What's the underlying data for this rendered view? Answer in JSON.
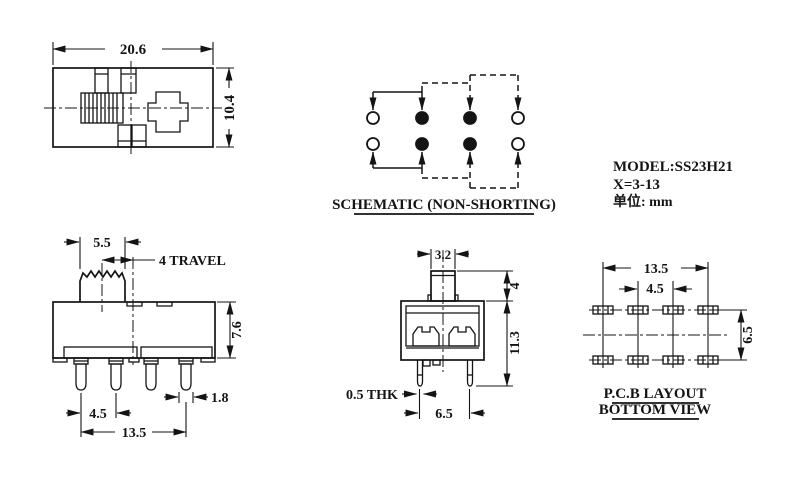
{
  "drawing_info": {
    "model": "MODEL:SS23H21",
    "travel_range": "X=3-13",
    "unit": "单位: mm",
    "line_color": "#141414",
    "background_color": "#ffffff"
  },
  "top_view": {
    "dim_width": "20.6",
    "dim_height": "10.4"
  },
  "schematic": {
    "title": "SCHEMATIC (NON-SHORTING)",
    "pin_rows": 2,
    "pins_per_row": 4,
    "pin_states": [
      [
        "open",
        "filled",
        "filled",
        "open"
      ],
      [
        "open",
        "filled",
        "filled",
        "open"
      ]
    ],
    "position1_linkage": "solid",
    "position2_3_linkage": "dashed"
  },
  "front_view": {
    "dim_knob_width": "5.5",
    "dim_travel": "4 TRAVEL",
    "dim_body_height": "7.6",
    "dim_pin_pitch": "4.5",
    "dim_pin_span": "13.5",
    "dim_pin_width": "1.8"
  },
  "side_view": {
    "dim_knob_width": "3.2",
    "dim_knob_height": "4",
    "dim_height": "11.3",
    "dim_terminal_thickness": "0.5 THK",
    "dim_pin_spacing": "6.5"
  },
  "pcb_layout": {
    "title_line1": "P.C.B LAYOUT",
    "title_line2": "BOTTOM VIEW",
    "dim_span": "13.5",
    "dim_pitch": "4.5",
    "dim_row_spacing": "6.5"
  }
}
